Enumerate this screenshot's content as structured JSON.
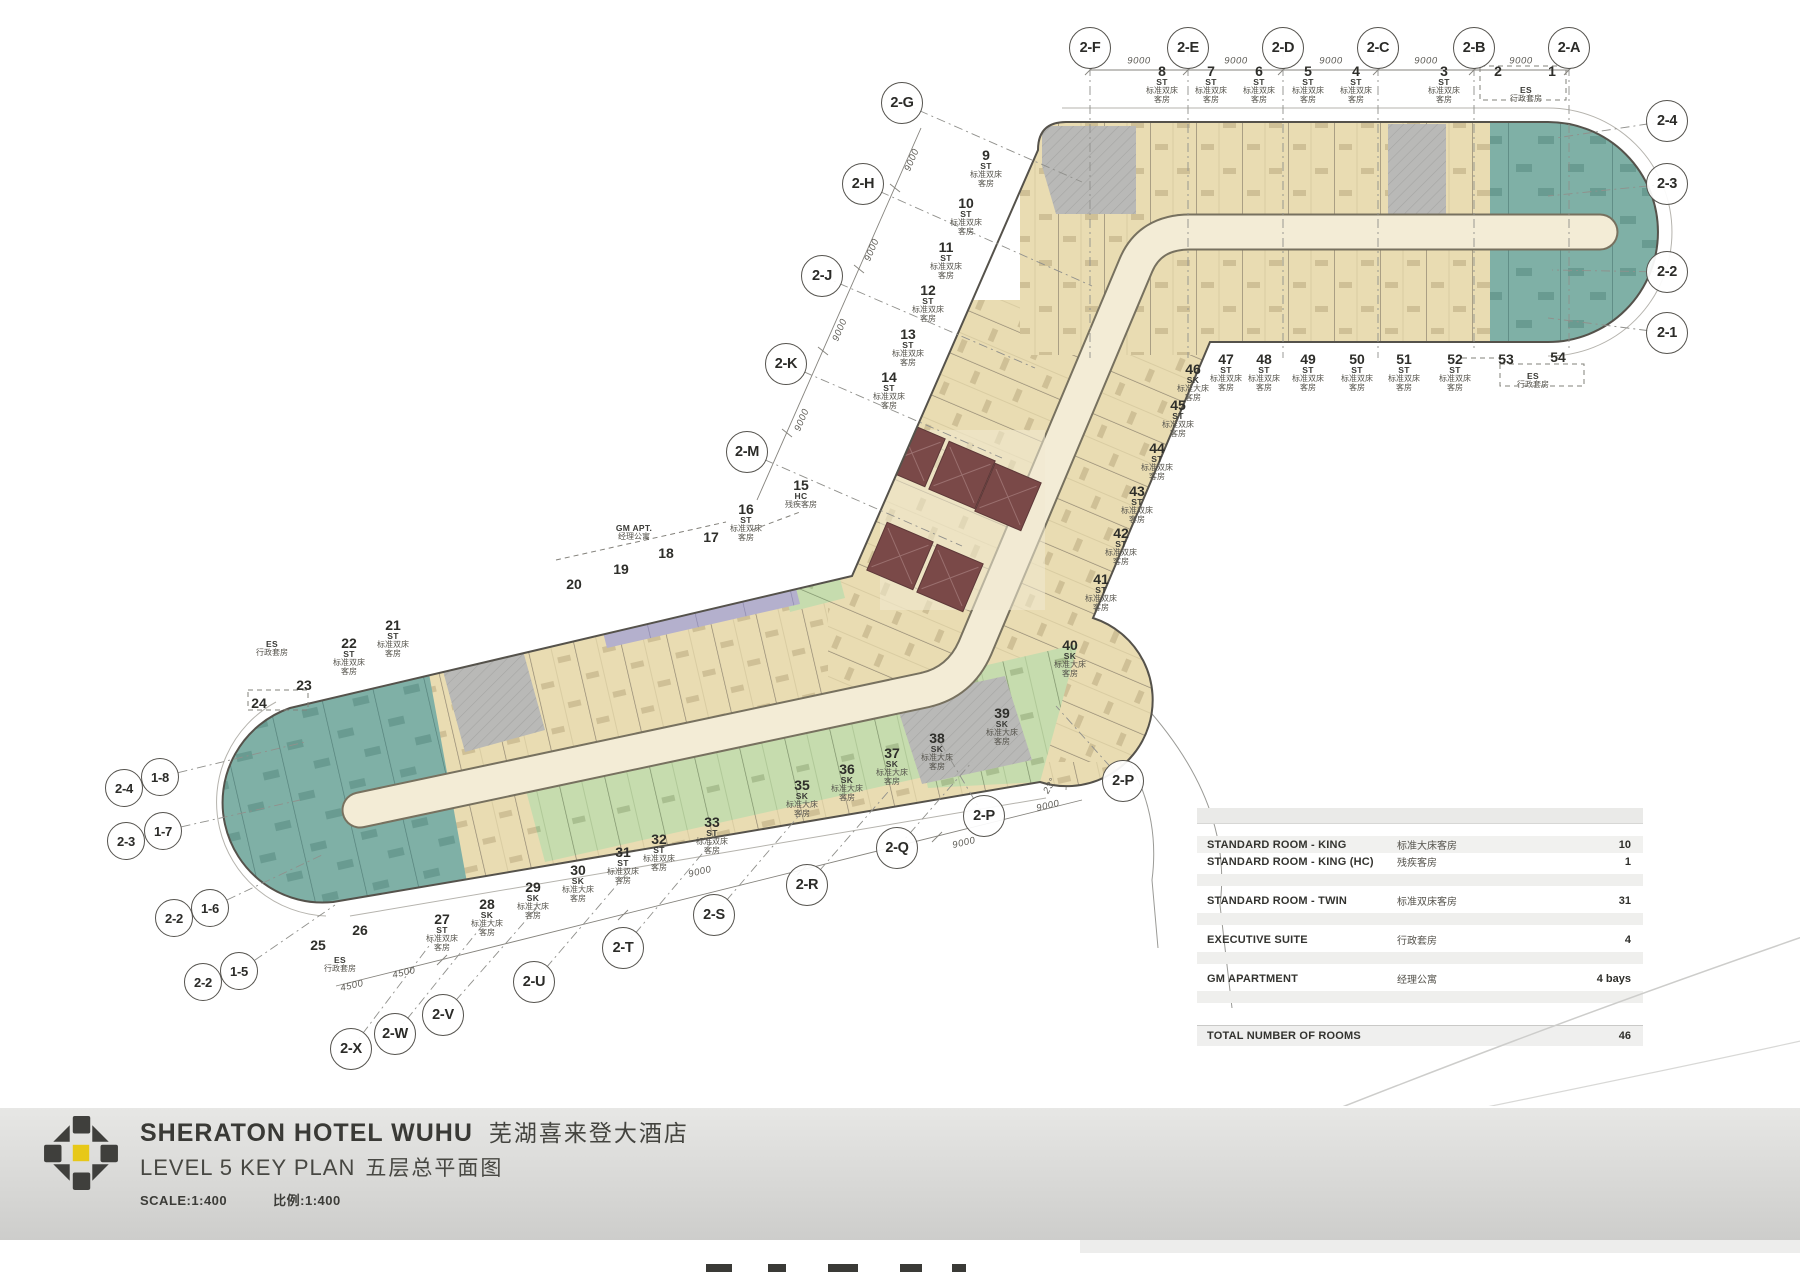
{
  "title_block": {
    "hotel_name_en": "SHERATON HOTEL WUHU",
    "hotel_name_cn": "芜湖喜来登大酒店",
    "plan_name_en": "LEVEL 5 KEY PLAN",
    "plan_name_cn": "五层总平面图",
    "scale_en": "SCALE:1:400",
    "scale_cn": "比例:1:400"
  },
  "legend": {
    "rows": [
      {
        "en": "STANDARD ROOM - KING",
        "cn": "标准大床客房",
        "count": "10",
        "shade": true
      },
      {
        "en": "STANDARD ROOM - KING  (HC)",
        "cn": "残疾客房",
        "count": "1",
        "shade": false
      },
      {
        "en": "STANDARD ROOM - TWIN",
        "cn": "标准双床客房",
        "count": "31",
        "shade": false
      },
      {
        "en": "EXECUTIVE SUITE",
        "cn": "行政套房",
        "count": "4",
        "shade": false
      },
      {
        "en": "GM APARTMENT",
        "cn": "经理公寓",
        "count": "4 bays",
        "shade": false
      }
    ],
    "total_label": "TOTAL NUMBER OF ROOMS",
    "total_count": "46"
  },
  "room_type_colors": {
    "standard_twin": "#e9dcb2",
    "standard_king": "#c6dcae",
    "executive_suite": "#7fb0a6",
    "gm_apartment": "#b4b0cd",
    "elevator_core": "#7a4948",
    "service_gray": "#b9b9b7",
    "corridor": "#f3ecd6",
    "logo_yellow": "#e7c818"
  },
  "grid_bubbles": [
    {
      "l": "2-F",
      "x": 1090,
      "y": 48,
      "ex": 1090,
      "ey": 358
    },
    {
      "l": "2-E",
      "x": 1188,
      "y": 48,
      "ex": 1188,
      "ey": 358
    },
    {
      "l": "2-D",
      "x": 1283,
      "y": 48,
      "ex": 1283,
      "ey": 358
    },
    {
      "l": "2-C",
      "x": 1378,
      "y": 48,
      "ex": 1378,
      "ey": 358
    },
    {
      "l": "2-B",
      "x": 1474,
      "y": 48,
      "ex": 1474,
      "ey": 352
    },
    {
      "l": "2-A",
      "x": 1569,
      "y": 48,
      "ex": 1569,
      "ey": 348
    },
    {
      "l": "2-4",
      "x": 1667,
      "y": 121,
      "ex": 1556,
      "ey": 138
    },
    {
      "l": "2-3",
      "x": 1667,
      "y": 184,
      "ex": 1548,
      "ey": 196
    },
    {
      "l": "2-2",
      "x": 1667,
      "y": 272,
      "ex": 1552,
      "ey": 270
    },
    {
      "l": "2-1",
      "x": 1667,
      "y": 333,
      "ex": 1548,
      "ey": 318
    },
    {
      "l": "2-G",
      "x": 902,
      "y": 103,
      "ex": 1082,
      "ey": 182
    },
    {
      "l": "2-H",
      "x": 863,
      "y": 184,
      "ex": 1092,
      "ey": 286
    },
    {
      "l": "2-J",
      "x": 822,
      "y": 276,
      "ex": 1035,
      "ey": 368
    },
    {
      "l": "2-K",
      "x": 786,
      "y": 364,
      "ex": 1002,
      "ey": 458
    },
    {
      "l": "2-M",
      "x": 747,
      "y": 452,
      "ex": 962,
      "ey": 546
    },
    {
      "l": "2-P",
      "x": 984,
      "y": 816,
      "ex": 940,
      "ey": 742
    },
    {
      "l": "2-P",
      "x": 1123,
      "y": 781,
      "ex": 1056,
      "ey": 706
    },
    {
      "l": "2-Q",
      "x": 897,
      "y": 848,
      "ex": 972,
      "ey": 762
    },
    {
      "l": "2-R",
      "x": 807,
      "y": 885,
      "ex": 888,
      "ey": 792
    },
    {
      "l": "2-S",
      "x": 714,
      "y": 915,
      "ex": 802,
      "ey": 812
    },
    {
      "l": "2-T",
      "x": 623,
      "y": 948,
      "ex": 712,
      "ey": 842
    },
    {
      "l": "2-U",
      "x": 534,
      "y": 982,
      "ex": 628,
      "ey": 872
    },
    {
      "l": "2-V",
      "x": 443,
      "y": 1015,
      "ex": 542,
      "ey": 902
    },
    {
      "l": "2-W",
      "x": 395,
      "y": 1034,
      "ex": 482,
      "ey": 926
    },
    {
      "l": "2-X",
      "x": 351,
      "y": 1049,
      "ex": 432,
      "ey": 942
    },
    {
      "l": "2-4",
      "x": 124,
      "y": 788,
      "s": 36
    },
    {
      "l": "1-8",
      "x": 160,
      "y": 777,
      "s": 36,
      "ex": 305,
      "ey": 742
    },
    {
      "l": "2-3",
      "x": 126,
      "y": 841,
      "s": 36
    },
    {
      "l": "1-7",
      "x": 163,
      "y": 831,
      "s": 36,
      "ex": 300,
      "ey": 800
    },
    {
      "l": "2-2",
      "x": 174,
      "y": 918,
      "s": 36
    },
    {
      "l": "1-6",
      "x": 210,
      "y": 908,
      "s": 36,
      "ex": 322,
      "ey": 855
    },
    {
      "l": "2-2",
      "x": 203,
      "y": 982,
      "s": 36
    },
    {
      "l": "1-5",
      "x": 239,
      "y": 971,
      "s": 36,
      "ex": 335,
      "ey": 905
    }
  ],
  "room_callouts": [
    {
      "n": "8",
      "c": "ST",
      "t": "标准双床客房",
      "x": 1162,
      "y": 64
    },
    {
      "n": "7",
      "c": "ST",
      "t": "标准双床客房",
      "x": 1211,
      "y": 64
    },
    {
      "n": "6",
      "c": "ST",
      "t": "标准双床客房",
      "x": 1259,
      "y": 64
    },
    {
      "n": "5",
      "c": "ST",
      "t": "标准双床客房",
      "x": 1308,
      "y": 64
    },
    {
      "n": "4",
      "c": "ST",
      "t": "标准双床客房",
      "x": 1356,
      "y": 64
    },
    {
      "n": "3",
      "c": "ST",
      "t": "标准双床客房",
      "x": 1444,
      "y": 64
    },
    {
      "n": "2",
      "x": 1498,
      "y": 64
    },
    {
      "n": "1",
      "x": 1552,
      "y": 64
    },
    {
      "c": "ES",
      "t": "行政套房",
      "x": 1526,
      "y": 86
    },
    {
      "n": "46",
      "c": "SK",
      "t": "标准大床客房",
      "x": 1193,
      "y": 362
    },
    {
      "n": "47",
      "c": "ST",
      "t": "标准双床客房",
      "x": 1226,
      "y": 352
    },
    {
      "n": "48",
      "c": "ST",
      "t": "标准双床客房",
      "x": 1264,
      "y": 352
    },
    {
      "n": "49",
      "c": "ST",
      "t": "标准双床客房",
      "x": 1308,
      "y": 352
    },
    {
      "n": "50",
      "c": "ST",
      "t": "标准双床客房",
      "x": 1357,
      "y": 352
    },
    {
      "n": "51",
      "c": "ST",
      "t": "标准双床客房",
      "x": 1404,
      "y": 352
    },
    {
      "n": "52",
      "c": "ST",
      "t": "标准双床客房",
      "x": 1455,
      "y": 352
    },
    {
      "n": "53",
      "x": 1506,
      "y": 352
    },
    {
      "n": "54",
      "x": 1558,
      "y": 350
    },
    {
      "c": "ES",
      "t": "行政套房",
      "x": 1533,
      "y": 372
    },
    {
      "n": "9",
      "c": "ST",
      "t": "标准双床客房",
      "x": 986,
      "y": 148
    },
    {
      "n": "10",
      "c": "ST",
      "t": "标准双床客房",
      "x": 966,
      "y": 196
    },
    {
      "n": "11",
      "c": "ST",
      "t": "标准双床客房",
      "x": 946,
      "y": 240
    },
    {
      "n": "12",
      "c": "ST",
      "t": "标准双床客房",
      "x": 928,
      "y": 283
    },
    {
      "n": "13",
      "c": "ST",
      "t": "标准双床客房",
      "x": 908,
      "y": 327
    },
    {
      "n": "14",
      "c": "ST",
      "t": "标准双床客房",
      "x": 889,
      "y": 370
    },
    {
      "n": "45",
      "c": "ST",
      "t": "标准双床客房",
      "x": 1178,
      "y": 398
    },
    {
      "n": "44",
      "c": "ST",
      "t": "标准双床客房",
      "x": 1157,
      "y": 441
    },
    {
      "n": "43",
      "c": "ST",
      "t": "标准双床客房",
      "x": 1137,
      "y": 484
    },
    {
      "n": "42",
      "c": "ST",
      "t": "标准双床客房",
      "x": 1121,
      "y": 526
    },
    {
      "n": "41",
      "c": "ST",
      "t": "标准双床客房",
      "x": 1101,
      "y": 572
    },
    {
      "n": "40",
      "c": "SK",
      "t": "标准大床客房",
      "x": 1070,
      "y": 638
    },
    {
      "n": "15",
      "c": "HC",
      "t": "残疾客房",
      "x": 801,
      "y": 478
    },
    {
      "n": "16",
      "c": "ST",
      "t": "标准双床客房",
      "x": 746,
      "y": 502
    },
    {
      "n": "17",
      "x": 711,
      "y": 530
    },
    {
      "n": "18",
      "x": 666,
      "y": 546
    },
    {
      "n": "19",
      "x": 621,
      "y": 562
    },
    {
      "n": "20",
      "x": 574,
      "y": 577
    },
    {
      "c": "GM APT.",
      "t": "经理公寓",
      "x": 634,
      "y": 524
    },
    {
      "n": "21",
      "c": "ST",
      "t": "标准双床客房",
      "x": 393,
      "y": 618
    },
    {
      "n": "22",
      "c": "ST",
      "t": "标准双床客房",
      "x": 349,
      "y": 636
    },
    {
      "n": "23",
      "x": 304,
      "y": 678
    },
    {
      "n": "24",
      "x": 259,
      "y": 696
    },
    {
      "c": "ES",
      "t": "行政套房",
      "x": 272,
      "y": 640
    },
    {
      "n": "25",
      "x": 318,
      "y": 938
    },
    {
      "n": "26",
      "x": 360,
      "y": 923
    },
    {
      "c": "ES",
      "t": "行政套房",
      "x": 340,
      "y": 956
    },
    {
      "n": "27",
      "c": "ST",
      "t": "标准双床客房",
      "x": 442,
      "y": 912
    },
    {
      "n": "28",
      "c": "SK",
      "t": "标准大床客房",
      "x": 487,
      "y": 897
    },
    {
      "n": "29",
      "c": "SK",
      "t": "标准大床客房",
      "x": 533,
      "y": 880
    },
    {
      "n": "30",
      "c": "SK",
      "t": "标准大床客房",
      "x": 578,
      "y": 863
    },
    {
      "n": "31",
      "c": "ST",
      "t": "标准双床客房",
      "x": 623,
      "y": 845
    },
    {
      "n": "32",
      "c": "ST",
      "t": "标准双床客房",
      "x": 659,
      "y": 832
    },
    {
      "n": "33",
      "c": "ST",
      "t": "标准双床客房",
      "x": 712,
      "y": 815
    },
    {
      "n": "35",
      "c": "SK",
      "t": "标准大床客房",
      "x": 802,
      "y": 778
    },
    {
      "n": "36",
      "c": "SK",
      "t": "标准大床客房",
      "x": 847,
      "y": 762
    },
    {
      "n": "37",
      "c": "SK",
      "t": "标准大床客房",
      "x": 892,
      "y": 746
    },
    {
      "n": "38",
      "c": "SK",
      "t": "标准大床客房",
      "x": 937,
      "y": 731
    },
    {
      "n": "39",
      "c": "SK",
      "t": "标准大床客房",
      "x": 1002,
      "y": 706
    }
  ],
  "dimensions": [
    {
      "t": "9000",
      "x": 1139,
      "y": 61,
      "r": 0
    },
    {
      "t": "9000",
      "x": 1236,
      "y": 61,
      "r": 0
    },
    {
      "t": "9000",
      "x": 1331,
      "y": 61,
      "r": 0
    },
    {
      "t": "9000",
      "x": 1426,
      "y": 61,
      "r": 0
    },
    {
      "t": "9000",
      "x": 1521,
      "y": 61,
      "r": 0
    },
    {
      "t": "9000",
      "x": 912,
      "y": 160,
      "r": -67
    },
    {
      "t": "9000",
      "x": 872,
      "y": 250,
      "r": -67
    },
    {
      "t": "9000",
      "x": 840,
      "y": 330,
      "r": -67
    },
    {
      "t": "9000",
      "x": 802,
      "y": 420,
      "r": -67
    },
    {
      "t": "9000",
      "x": 700,
      "y": 872,
      "r": -13
    },
    {
      "t": "9000",
      "x": 964,
      "y": 843,
      "r": -13
    },
    {
      "t": "9000",
      "x": 1048,
      "y": 806,
      "r": -13
    },
    {
      "t": "4500",
      "x": 352,
      "y": 986,
      "r": -13
    },
    {
      "t": "4500",
      "x": 404,
      "y": 973,
      "r": -13
    },
    {
      "t": "23°",
      "x": 1050,
      "y": 786,
      "r": -60
    }
  ]
}
